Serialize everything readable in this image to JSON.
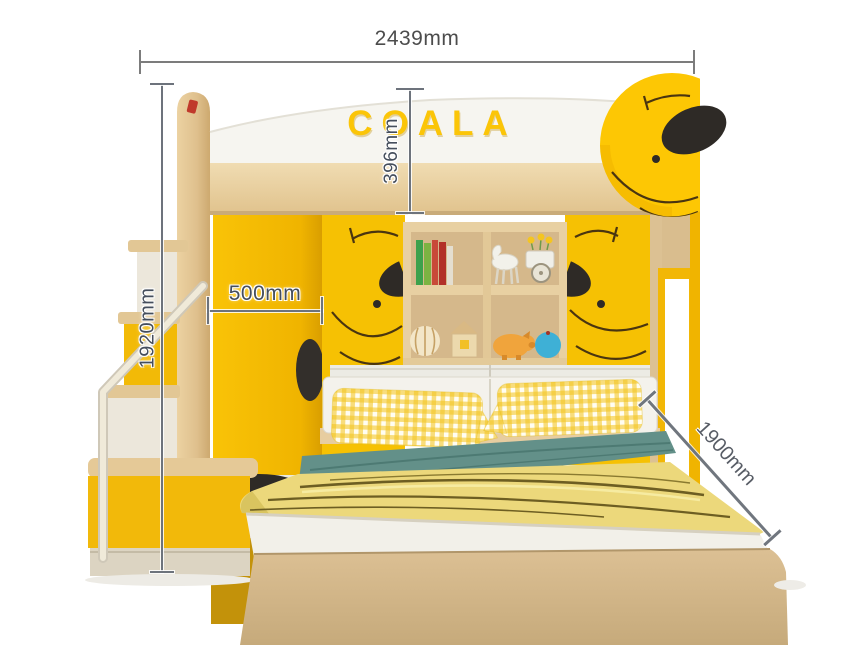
{
  "page": {
    "description": "Product illustration of a kids loft bunk bed (wardrobe, bookshelf, stairs, lower bed) with measurement callouts",
    "background": "#FFFFFF"
  },
  "logo": {
    "text": "COALA",
    "color": "#FBC508"
  },
  "annotations": {
    "total_width": {
      "label": "2439mm",
      "orientation": "horizontal-top"
    },
    "headboard_height": {
      "label": "396mm",
      "orientation": "vertical-center"
    },
    "overall_height": {
      "label": "1920mm",
      "orientation": "vertical-left"
    },
    "wardrobe_width": {
      "label": "500mm",
      "orientation": "horizontal-on-door"
    },
    "bed_length": {
      "label": "1900mm",
      "orientation": "diagonal-right"
    }
  },
  "furniture": {
    "colors": {
      "primary_yellow": "#F5BB07",
      "koala_yellow": "#FDC704",
      "wood_light": "#EAD5A8",
      "wood_mid": "#D9BC8E",
      "white_panel": "#F6F5F0",
      "teal_sheet": "#64908A",
      "blanket_yellow": "#ECD87B",
      "black_accent": "#2E2A26",
      "dimension_text": "#454E5C"
    },
    "shelf_items": [
      "books",
      "toy-horse-cart",
      "striped-ball",
      "block-house",
      "piggy-bank",
      "blue-ball"
    ],
    "decals": [
      "koala-head",
      "koala-face-left",
      "koala-face-right",
      "koala-feet"
    ]
  }
}
